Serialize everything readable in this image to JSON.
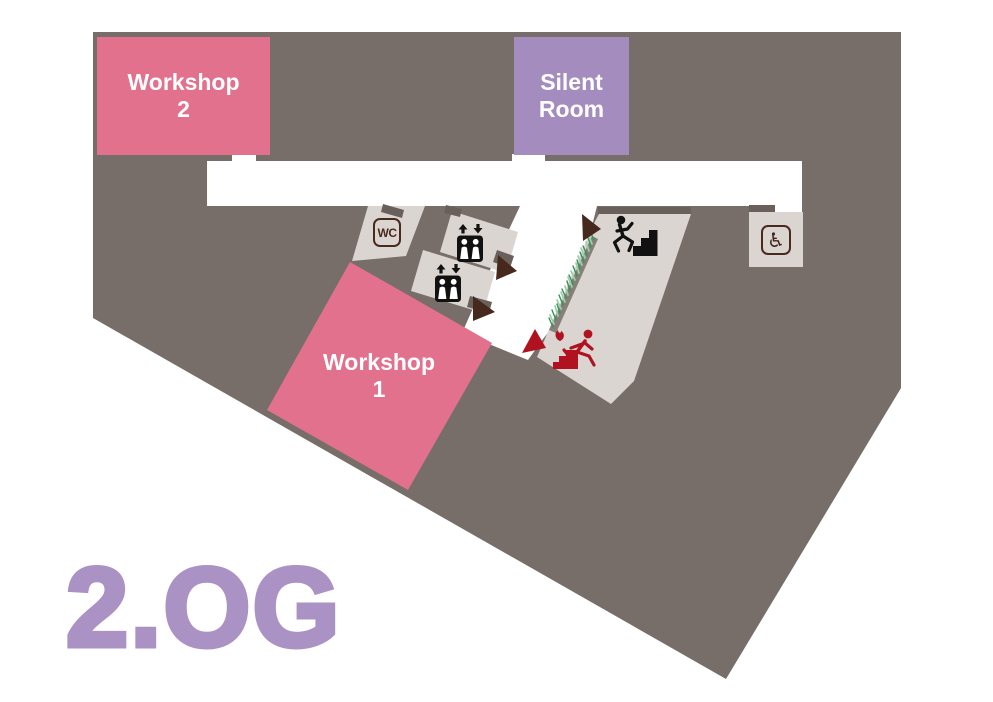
{
  "floor_plan": {
    "floor_label": "2.OG",
    "rooms": [
      {
        "id": "workshop-2",
        "name": "Workshop 2",
        "label_line1": "Workshop",
        "label_line2": "2",
        "color": "#e2718e"
      },
      {
        "id": "silent-room",
        "name": "Silent Room",
        "label_line1": "Silent",
        "label_line2": "Room",
        "color": "#a58cbf"
      },
      {
        "id": "workshop-1",
        "name": "Workshop 1",
        "label_line1": "Workshop",
        "label_line2": "1",
        "color": "#e2718e"
      }
    ],
    "facilities": [
      {
        "id": "wc",
        "label": "WC"
      },
      {
        "id": "accessible-wc",
        "symbol": "♿"
      },
      {
        "id": "elevator-upper"
      },
      {
        "id": "elevator-lower"
      },
      {
        "id": "staircase-up"
      },
      {
        "id": "emergency-exit-stairs"
      }
    ],
    "colors": {
      "floor_background": "#776d69",
      "corridor": "#ffffff",
      "room_light": "#dbd5d2",
      "room_pink": "#e2718e",
      "room_purple": "#a58cbf",
      "title_purple": "#ab92c4",
      "wall_dark": "#6a605b",
      "wall_ramp": "#878078",
      "icon_black": "#111111",
      "icon_brown": "#46281c",
      "alert_red": "#b1121f",
      "hatch_green_dark": "#37915c",
      "hatch_green_light": "#9ccfa8"
    }
  }
}
